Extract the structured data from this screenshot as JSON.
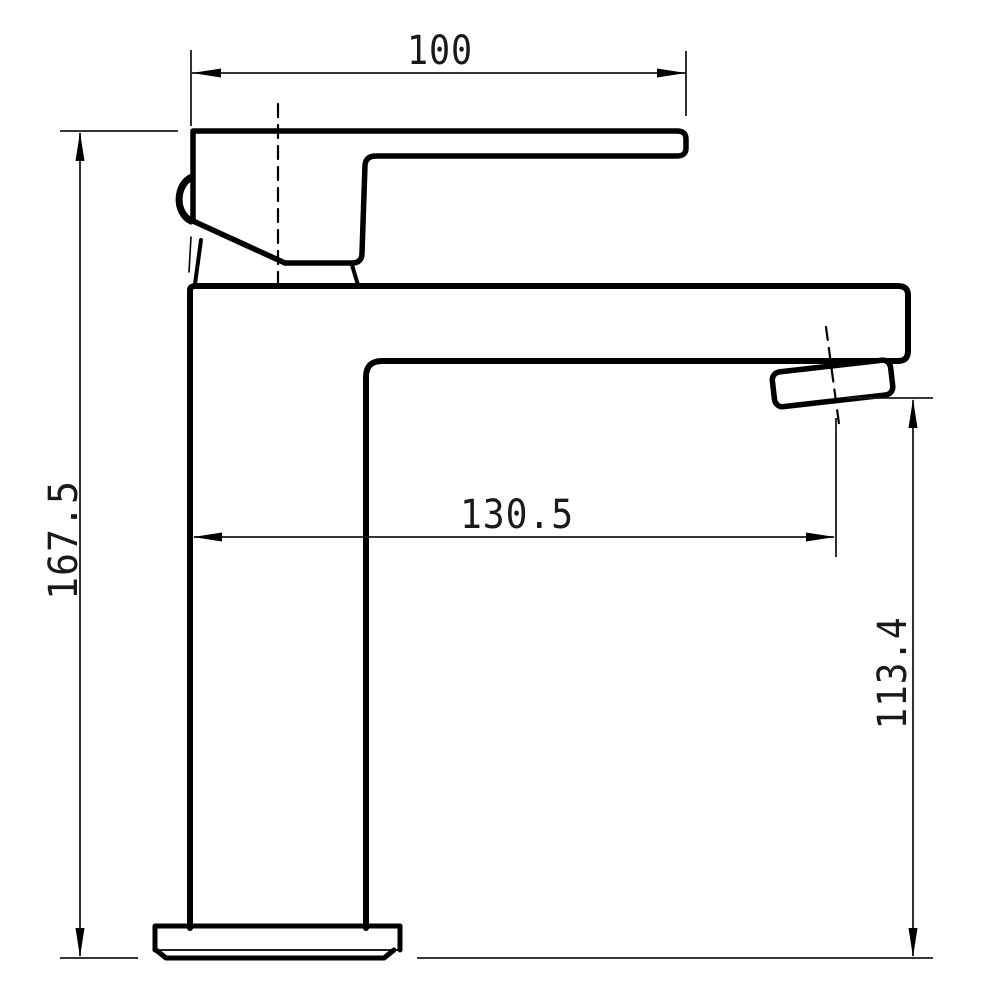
{
  "palette": {
    "background": "#ffffff",
    "outline": "#000000",
    "dimension_lines": "#1a1a1a",
    "text": "#1a1a1a"
  },
  "dimensions": {
    "top_width": {
      "label": "100"
    },
    "overall_height": {
      "label": "167.5"
    },
    "spout_reach": {
      "label": "130.5"
    },
    "outlet_height": {
      "label": "113.4"
    }
  }
}
